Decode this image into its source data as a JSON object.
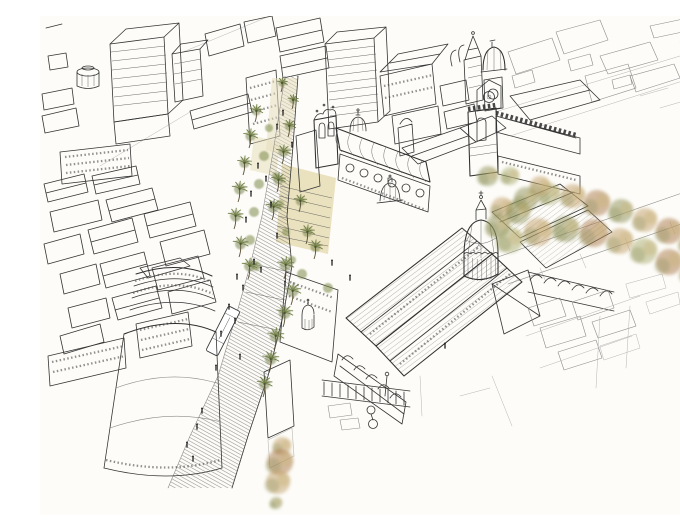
{
  "meta": {
    "width": 680,
    "height": 499,
    "background": "#fdfcf8",
    "kind": "hand-drawn aerial perspective sketch of a historic city centre, ink line work with watercolor trees"
  },
  "palette": {
    "background": "#fdfcf8",
    "ink": "#343434",
    "ink_light": "#8c8c8c",
    "ink_faint": "#b5b5b5",
    "roof_tint": "#e9ecec",
    "pavement": "#e6dcb4",
    "pavement_light": "#efe8cd",
    "wall_shade": "#cccccc",
    "palm_green": "#6f7d44",
    "palm_trunk": "#5a5136",
    "shrub_green": "#7d8a4c",
    "tree_olive": "#8e9158",
    "tree_tan": "#c2a06a",
    "tree_rust": "#aa7a4c",
    "tree_pale": "#aaae72",
    "tree_sand": "#c9b277",
    "figure": "#222222",
    "bus_white": "#ffffff"
  },
  "scene": {
    "landmarks": [
      {
        "id": "market-hall",
        "label": "large market hall with ribbed roofs and central dome"
      },
      {
        "id": "church",
        "label": "church with bell gable, small dome and curved nave roof"
      },
      {
        "id": "crenellated-tower",
        "label": "gothic tower with battlements and side hall"
      },
      {
        "id": "baroque-bell-tower",
        "label": "baroque bell tower with ribbed dome"
      },
      {
        "id": "palm-boulevard",
        "label": "pedestrian boulevard lined with palm trees"
      },
      {
        "id": "stepped-plaza",
        "label": "stepped sand-coloured plaza in front of the church"
      },
      {
        "id": "curved-corner-building",
        "label": "tall rounded-corner building"
      },
      {
        "id": "autumn-tree-row",
        "label": "row of autumn-coloured trees along the rear street"
      },
      {
        "id": "city-bus",
        "label": "white bus on the hatched street"
      },
      {
        "id": "dense-rooftops",
        "label": "dense sketched rooftops fading at the margins"
      }
    ],
    "palms": [
      [
        215,
        106,
        11
      ],
      [
        209,
        132,
        12
      ],
      [
        203,
        159,
        12
      ],
      [
        198,
        186,
        13
      ],
      [
        194,
        213,
        13
      ],
      [
        199,
        241,
        13
      ],
      [
        208,
        263,
        13
      ],
      [
        248,
        121,
        11
      ],
      [
        242,
        148,
        12
      ],
      [
        237,
        176,
        12
      ],
      [
        232,
        204,
        13
      ],
      [
        244,
        263,
        14
      ],
      [
        251,
        289,
        14
      ],
      [
        243,
        311,
        14
      ],
      [
        234,
        334,
        14
      ],
      [
        229,
        357,
        14
      ],
      [
        223,
        381,
        13
      ],
      [
        241,
        76,
        9
      ],
      [
        252,
        93,
        9
      ],
      [
        266,
        228,
        12
      ],
      [
        274,
        243,
        12
      ],
      [
        259,
        196,
        11
      ]
    ],
    "shrubs": [
      [
        229,
        112,
        4
      ],
      [
        224,
        140,
        5
      ],
      [
        219,
        168,
        5
      ],
      [
        214,
        196,
        5
      ],
      [
        210,
        224,
        5
      ],
      [
        216,
        250,
        5
      ],
      [
        236,
        160,
        4
      ],
      [
        240,
        188,
        4
      ],
      [
        246,
        216,
        4
      ],
      [
        252,
        244,
        4
      ],
      [
        262,
        258,
        5
      ],
      [
        288,
        272,
        5
      ]
    ],
    "autumn_trees": [
      [
        462,
        192,
        11,
        "tree_tan"
      ],
      [
        486,
        183,
        12,
        "tree_olive"
      ],
      [
        509,
        178,
        11,
        "tree_pale"
      ],
      [
        533,
        180,
        12,
        "tree_tan"
      ],
      [
        557,
        187,
        13,
        "tree_rust"
      ],
      [
        581,
        195,
        12,
        "tree_olive"
      ],
      [
        605,
        204,
        12,
        "tree_tan"
      ],
      [
        629,
        215,
        13,
        "tree_rust"
      ],
      [
        651,
        227,
        12,
        "tree_tan"
      ],
      [
        470,
        224,
        13,
        "tree_pale"
      ],
      [
        498,
        216,
        14,
        "tree_tan"
      ],
      [
        526,
        213,
        13,
        "tree_olive"
      ],
      [
        554,
        217,
        14,
        "tree_rust"
      ],
      [
        580,
        225,
        13,
        "tree_tan"
      ],
      [
        604,
        235,
        13,
        "tree_pale"
      ],
      [
        629,
        246,
        13,
        "tree_rust"
      ],
      [
        652,
        257,
        12,
        "tree_tan"
      ],
      [
        448,
        160,
        10,
        "tree_olive"
      ],
      [
        470,
        160,
        9,
        "tree_pale"
      ],
      [
        500,
        170,
        10,
        "tree_tan"
      ],
      [
        478,
        196,
        12,
        "tree_olive"
      ],
      [
        458,
        210,
        12,
        "tree_olive"
      ],
      [
        242,
        430,
        9,
        "tree_tan"
      ],
      [
        240,
        446,
        13,
        "tree_rust"
      ],
      [
        238,
        466,
        12,
        "tree_tan"
      ],
      [
        236,
        487,
        6,
        "tree_olive"
      ]
    ],
    "people": [
      [
        218,
        150
      ],
      [
        226,
        163
      ],
      [
        211,
        178
      ],
      [
        231,
        189
      ],
      [
        206,
        204
      ],
      [
        237,
        220
      ],
      [
        214,
        246
      ],
      [
        221,
        254
      ],
      [
        245,
        268
      ],
      [
        197,
        261
      ],
      [
        203,
        272
      ],
      [
        189,
        291
      ],
      [
        195,
        305
      ],
      [
        181,
        318
      ],
      [
        200,
        341
      ],
      [
        176,
        352
      ],
      [
        162,
        395
      ],
      [
        157,
        411
      ],
      [
        147,
        429
      ],
      [
        153,
        443
      ],
      [
        243,
        97
      ],
      [
        237,
        111
      ],
      [
        252,
        129
      ],
      [
        292,
        247
      ],
      [
        310,
        262
      ],
      [
        405,
        330
      ]
    ]
  }
}
